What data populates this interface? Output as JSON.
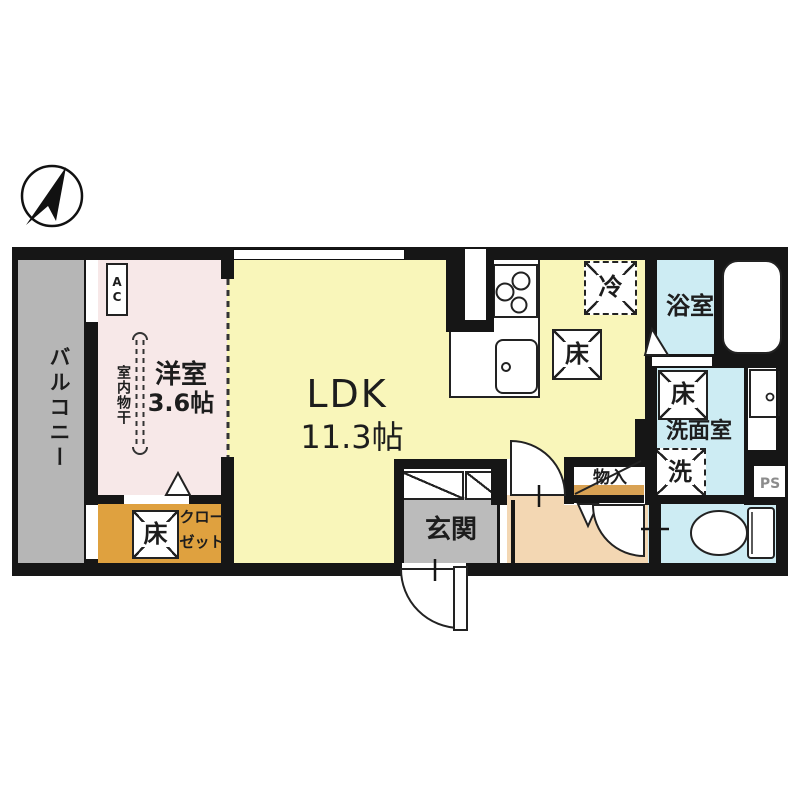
{
  "plan": {
    "title_hint": "apartment-floor-plan",
    "compass": "north-arrow",
    "balcony": {
      "label": "バルコニー"
    },
    "western_room": {
      "name": "洋室",
      "size": "3.6帖"
    },
    "ldk": {
      "name": "LDK",
      "size": "11.3帖"
    },
    "bathroom": {
      "label": "浴室"
    },
    "washroom": {
      "label": "洗面室"
    },
    "entrance": {
      "label": "玄関"
    },
    "closet": {
      "line1": "クロー",
      "line2": "ゼット"
    },
    "storage": {
      "label": "物入"
    },
    "pipe_space": {
      "label": "PS"
    },
    "equipment": {
      "ac": "AC",
      "fridge": "冷",
      "floor_storage": "床",
      "washer": "洗",
      "indoor_drying": "室内物干"
    },
    "colors": {
      "wall": "#161616",
      "ldk_fill": "#f9f6ba",
      "western_room_fill": "#f7e8e8",
      "wet_area_fill": "#cdecf3",
      "closet_fill": "#dfa13f",
      "hallway_fill": "#f3d7b3",
      "entrance_floor_fill": "#bbbbbb",
      "balcony_fill": "#b6b6b6",
      "storage_shelf_fill": "#d9a254",
      "ps_text": "#8c8c8c"
    }
  }
}
